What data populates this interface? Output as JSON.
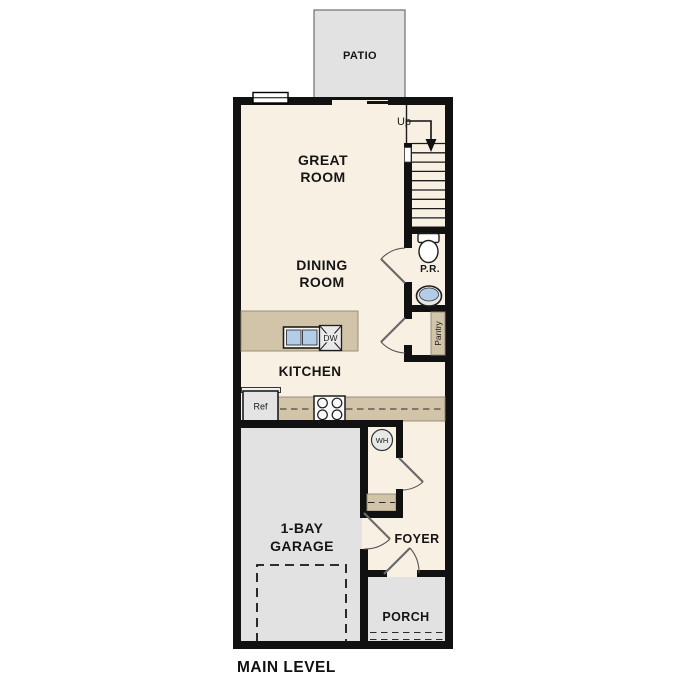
{
  "plan_title": "MAIN LEVEL",
  "rooms": {
    "patio": "PATIO",
    "great_room": [
      "GREAT",
      "ROOM"
    ],
    "dining_room": [
      "DINING",
      "ROOM"
    ],
    "kitchen": "KITCHEN",
    "garage": [
      "1-BAY",
      "GARAGE"
    ],
    "foyer": "FOYER",
    "porch": "PORCH",
    "powder_room": "P.R.",
    "pantry": "Pantry"
  },
  "fixtures": {
    "stairs_direction": "Up",
    "water_heater": "WH",
    "refrigerator": "Ref",
    "dishwasher": "DW"
  },
  "colors": {
    "floor": "#f8f0e2",
    "exterior_surfaces": "#e2e2e2",
    "counters": "#d2c4a9",
    "walls": "#111111",
    "sink_water": "#b3cde9"
  }
}
